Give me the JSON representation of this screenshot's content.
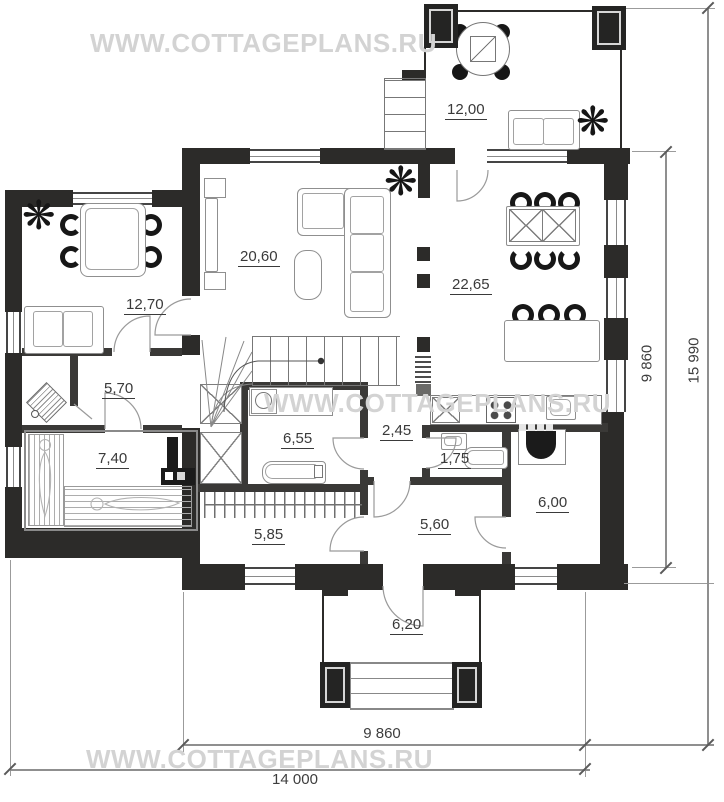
{
  "watermark": {
    "text": "WWW.COTTAGEPLANS.RU"
  },
  "rooms": {
    "terrace": "12,00",
    "dining": "12,70",
    "hall": "5,70",
    "sauna": "7,40",
    "living": "20,60",
    "kitchen": "22,65",
    "bathroom": "6,55",
    "lobby": "2,45",
    "wc": "1,75",
    "boiler": "6,00",
    "back_room": "5,60",
    "wardrobe": "5,85",
    "porch": "6,20"
  },
  "dimensions": {
    "right_inner": "9 860",
    "right_outer": "15 990",
    "bottom_inner": "9 860",
    "bottom_outer": "14 000"
  },
  "icons": {
    "plant": "❋"
  },
  "colors": {
    "wall": "#2c2b29",
    "watermark": "#d3d3d3",
    "line": "#9b9b9b"
  }
}
